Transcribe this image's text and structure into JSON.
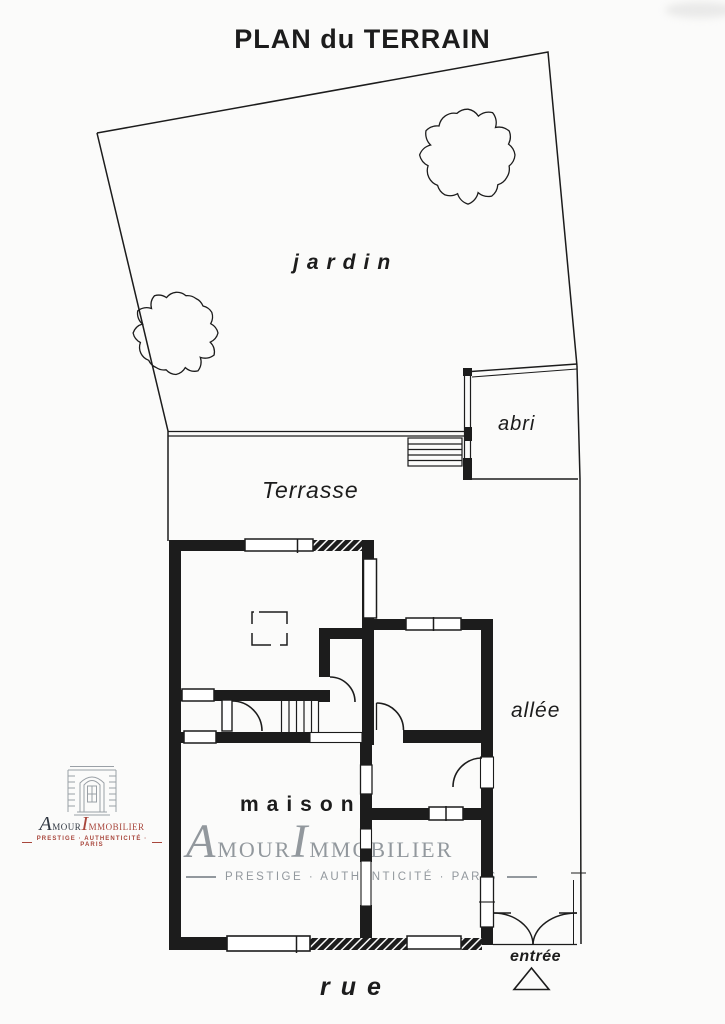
{
  "title": "PLAN du TERRAIN",
  "plan": {
    "jardin": "jardin",
    "terrasse": "Terrasse",
    "abri": "abri",
    "allee": "allée",
    "maison": "maison",
    "rue": "rue",
    "entree": "entrée"
  },
  "watermark": {
    "amour": "Amour",
    "immobilier": "Immobilier",
    "tagline": "PRESTIGE · AUTHENTICITÉ · PARIS"
  },
  "logo": {
    "amour": "Amour",
    "immobilier": "Immobilier",
    "tagline": "PRESTIGE · AUTHENTICITÉ · PARIS"
  },
  "colors": {
    "ink": "#1c1c1c",
    "paper": "#fbfbfa",
    "brand_red": "#a8463c",
    "brand_dark": "#2f3640",
    "watermark_gray": "#8a9096"
  }
}
